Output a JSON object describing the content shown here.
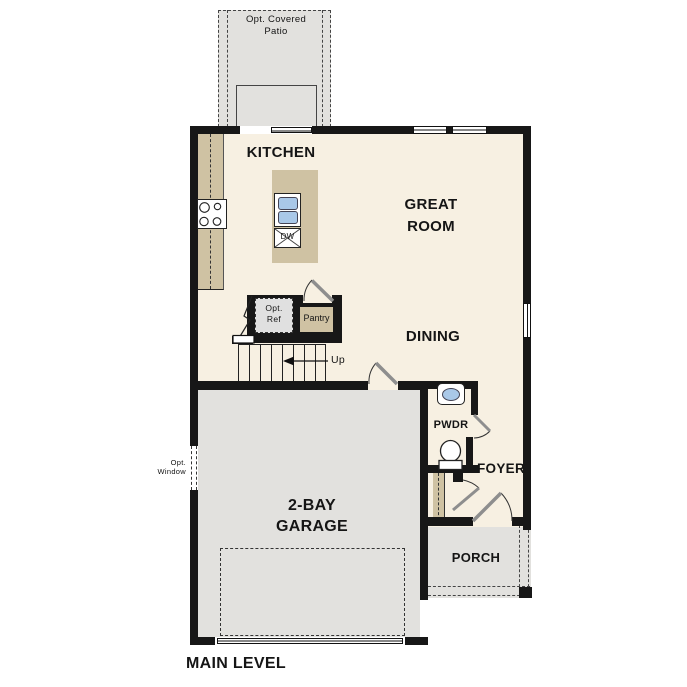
{
  "plan": {
    "footer_label": "MAIN LEVEL"
  },
  "rooms": {
    "patio": {
      "label": "Opt. Covered\nPatio"
    },
    "kitchen": {
      "label": "KITCHEN"
    },
    "great_room": {
      "label": "GREAT\nROOM"
    },
    "dining": {
      "label": "DINING"
    },
    "powder": {
      "label": "PWDR"
    },
    "foyer": {
      "label": "FOYER"
    },
    "garage": {
      "label": "2-BAY\nGARAGE"
    },
    "porch": {
      "label": "PORCH"
    }
  },
  "features": {
    "optional_refrigerator": {
      "label": "Opt.\nRef"
    },
    "pantry": {
      "label": "Pantry"
    },
    "dishwasher": {
      "label": "DW"
    },
    "stairs": {
      "direction_label": "Up"
    },
    "optional_window": {
      "label": "Opt.\nWindow"
    }
  },
  "colors": {
    "floor": "#f7f0e2",
    "cabinet": "#cfc2a3",
    "concrete": "#e2e1de",
    "wall": "#171717",
    "fixture-blue": "#a9c8e8",
    "door-leaf": "#8e8e8e",
    "appliance-gray": "#e0e0e0"
  }
}
